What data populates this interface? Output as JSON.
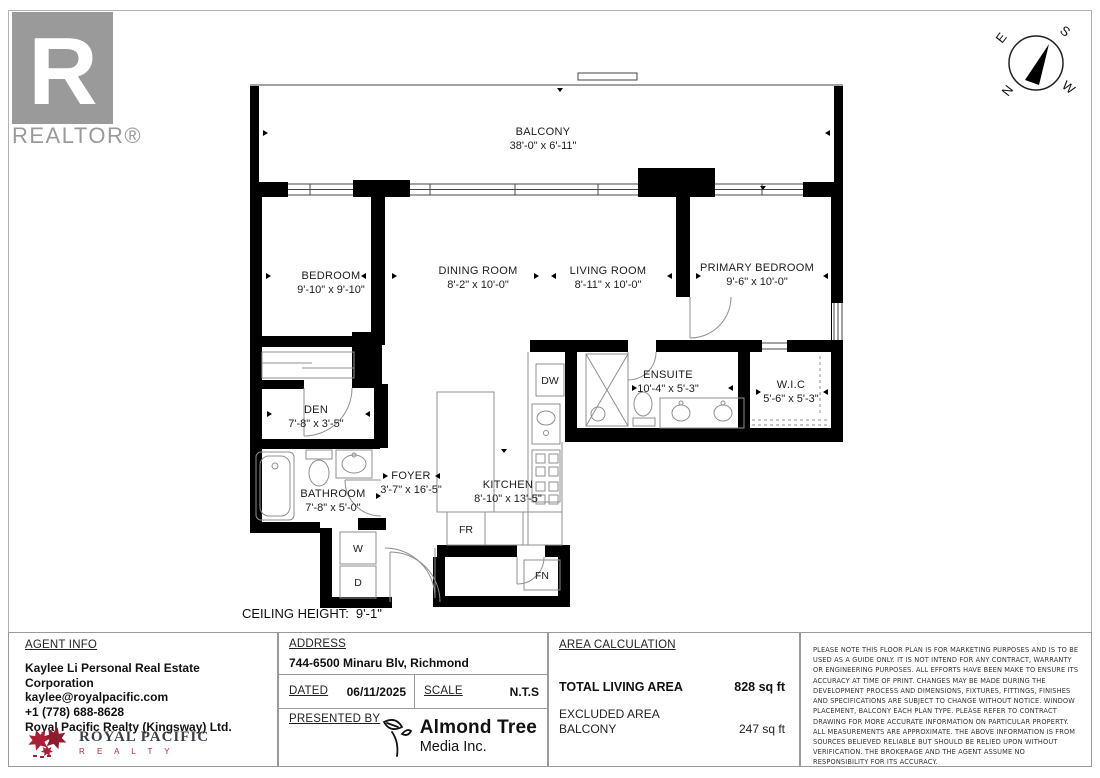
{
  "branding": {
    "realtor": "REALTOR®"
  },
  "compass": {
    "n": "N",
    "e": "E",
    "s": "S",
    "w": "W"
  },
  "floorplan": {
    "rooms": [
      {
        "name": "BALCONY",
        "dims": "38'-0\" x 6'-11\""
      },
      {
        "name": "BEDROOM",
        "dims": "9'-10\" x 9'-10\""
      },
      {
        "name": "DINING ROOM",
        "dims": "8'-2\" x 10'-0\""
      },
      {
        "name": "LIVING ROOM",
        "dims": "8'-11\" x 10'-0\""
      },
      {
        "name": "PRIMARY BEDROOM",
        "dims": "9'-6\" x 10'-0\""
      },
      {
        "name": "ENSUITE",
        "dims": "10'-4\" x 5'-3\""
      },
      {
        "name": "W.I.C",
        "dims": "5'-6\" x 5'-3\""
      },
      {
        "name": "DEN",
        "dims": "7'-8\" x 3'-5\""
      },
      {
        "name": "BATHROOM",
        "dims": "7'-8\" x 5'-0\""
      },
      {
        "name": "FOYER",
        "dims": "3'-7\" x 16'-5\""
      },
      {
        "name": "KITCHEN",
        "dims": "8'-10\" x 13'-5\""
      }
    ],
    "labels": {
      "dw": "DW",
      "fr": "FR",
      "fn": "FN",
      "washer": "W",
      "dryer": "D"
    },
    "ceiling": {
      "label": "CEILING HEIGHT:",
      "value": "9'-1\""
    }
  },
  "footer": {
    "agent": {
      "heading": "AGENT INFO",
      "company": "Kaylee Li Personal Real Estate Corporation",
      "email": "kaylee@royalpacific.com",
      "phone": "+1 (778) 688-8628",
      "brokerage": "Royal Pacific Realty (Kingsway) Ltd."
    },
    "brokerage_logo": {
      "name": "ROYAL PACIFIC",
      "sub": "R E A L T Y"
    },
    "address": {
      "heading": "ADDRESS",
      "value": "744-6500 Minaru Blv, Richmond"
    },
    "dated": {
      "label": "DATED",
      "value": "06/11/2025"
    },
    "scale": {
      "label": "SCALE",
      "value": "N.T.S"
    },
    "presented": {
      "label": "PRESENTED BY",
      "media_name": "Almond Tree",
      "media_sub": "Media Inc."
    },
    "area": {
      "heading": "AREA CALCULATION",
      "total_label": "TOTAL LIVING AREA",
      "total_value": "828 sq ft",
      "excluded_label": "EXCLUDED AREA",
      "excluded_room": "BALCONY",
      "excluded_value": "247 sq ft"
    },
    "disclaimer": "PLEASE NOTE THIS FLOOR PLAN IS FOR MARKETING PURPOSES AND IS TO BE USED AS A GUIDE ONLY. IT IS NOT INTEND FOR ANY CONTRACT, WARRANTY OR ENGINEERING PURPOSES. ALL EFFORTS HAVE BEEN MAKE TO ENSURE ITS ACCURACY AT TIME OF PRINT. CHANGES MAY BE MADE DURING THE DEVELOPMENT PROCESS AND DIMENSIONS, FIXTURES, FITTINGS, FINISHES AND SPECIFICATIONS ARE SUBJECT TO CHANGE WITHOUT NOTICE. WINDOW PLACEMENT, BALCONY EACH PLAN TYPE. PLEASE REFER TO CONTRACT DRAWING FOR MORE ACCURATE INFORMATION ON PARTICULAR PROPERTY. ALL MEASUREMENTS ARE APPROXIMATE. THE ABOVE INFORMATION IS FROM SOURCES BELIEVED RELIABLE BUT SHOULD BE RELIED UPON WITHOUT VERIFICATION. THE BROKERAGE AND THE AGENT ASSUME NO RESPONSIBILITY FOR ITS ACCURACY."
  }
}
